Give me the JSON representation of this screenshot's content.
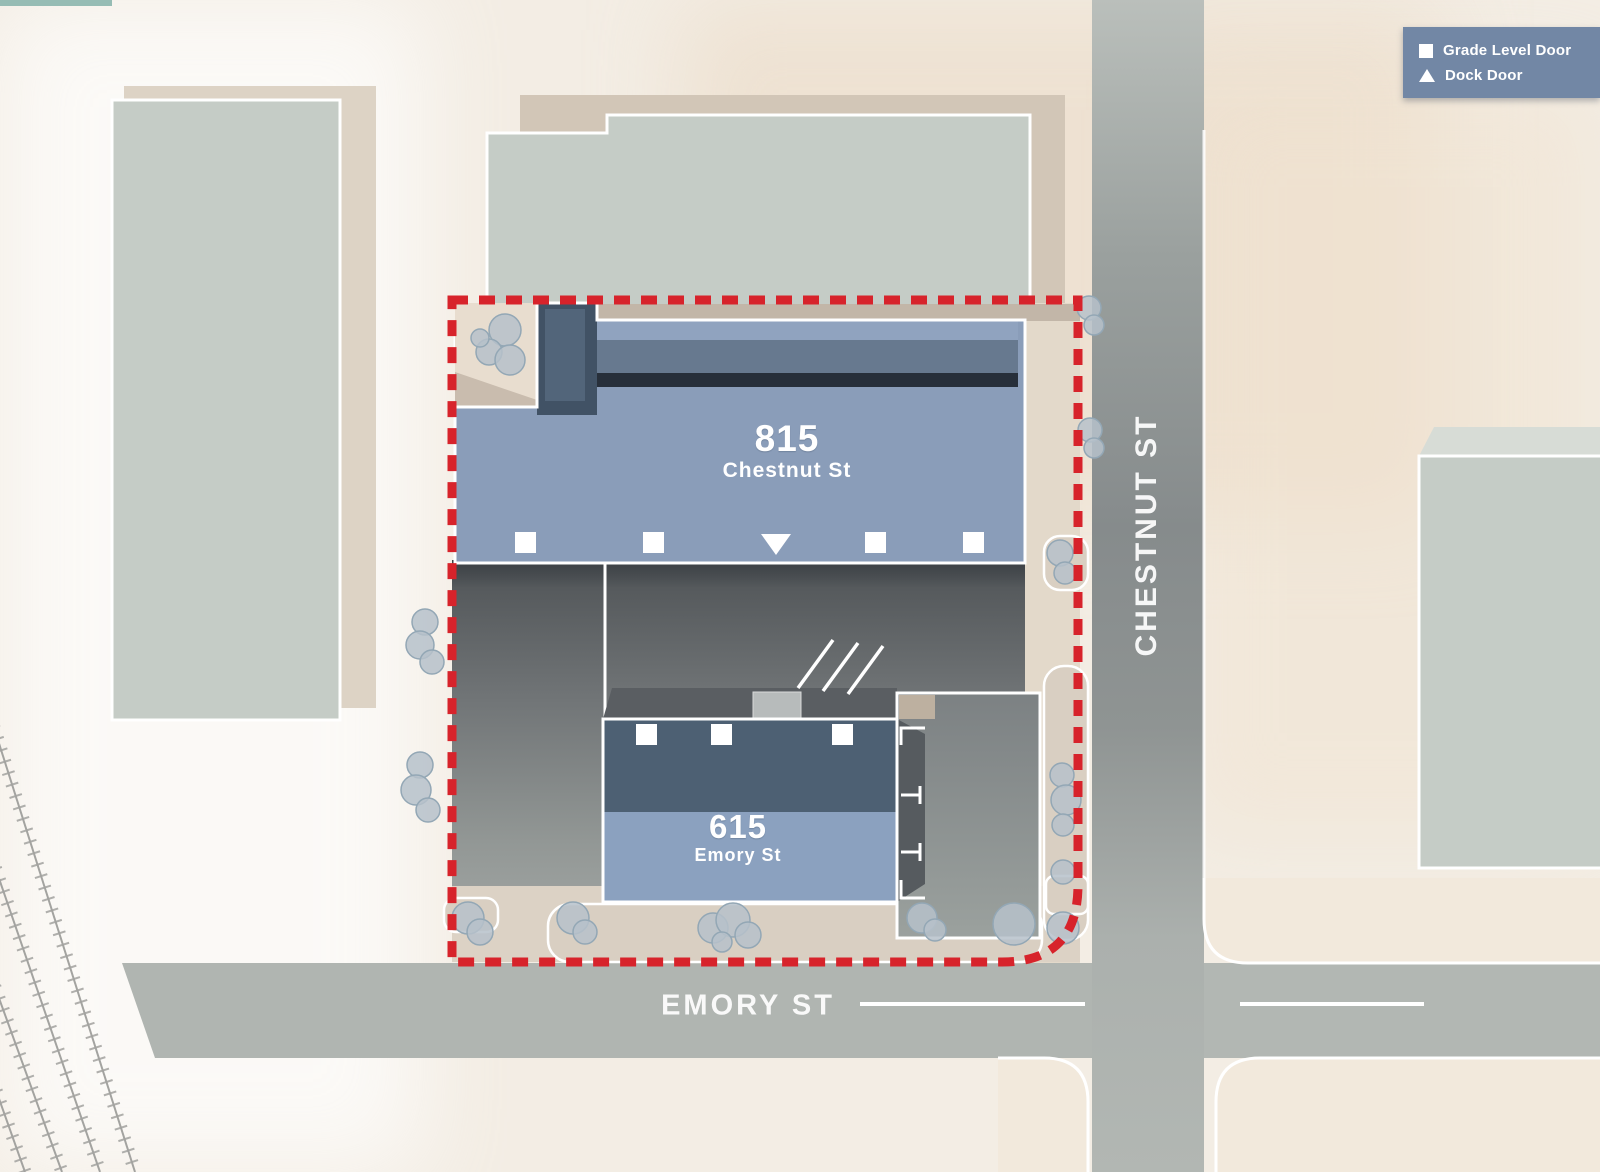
{
  "legend": {
    "items": [
      {
        "icon": "square",
        "label": "Grade Level Door"
      },
      {
        "icon": "triangle",
        "label": "Dock Door"
      }
    ]
  },
  "streets": {
    "chestnut": "CHESTNUT ST",
    "emory": "EMORY ST"
  },
  "buildings": {
    "b815": {
      "number": "815",
      "street": "Chestnut St"
    },
    "b615": {
      "number": "615",
      "street": "Emory St"
    }
  },
  "colors": {
    "boundary_red": "#d7232b",
    "building_body_blue": "#8a9db9",
    "building_dark_blue": "#4d6073",
    "legend_blue": "#7287a5",
    "context_building": "#c5ccc6",
    "street_gray": "#8f9493"
  }
}
